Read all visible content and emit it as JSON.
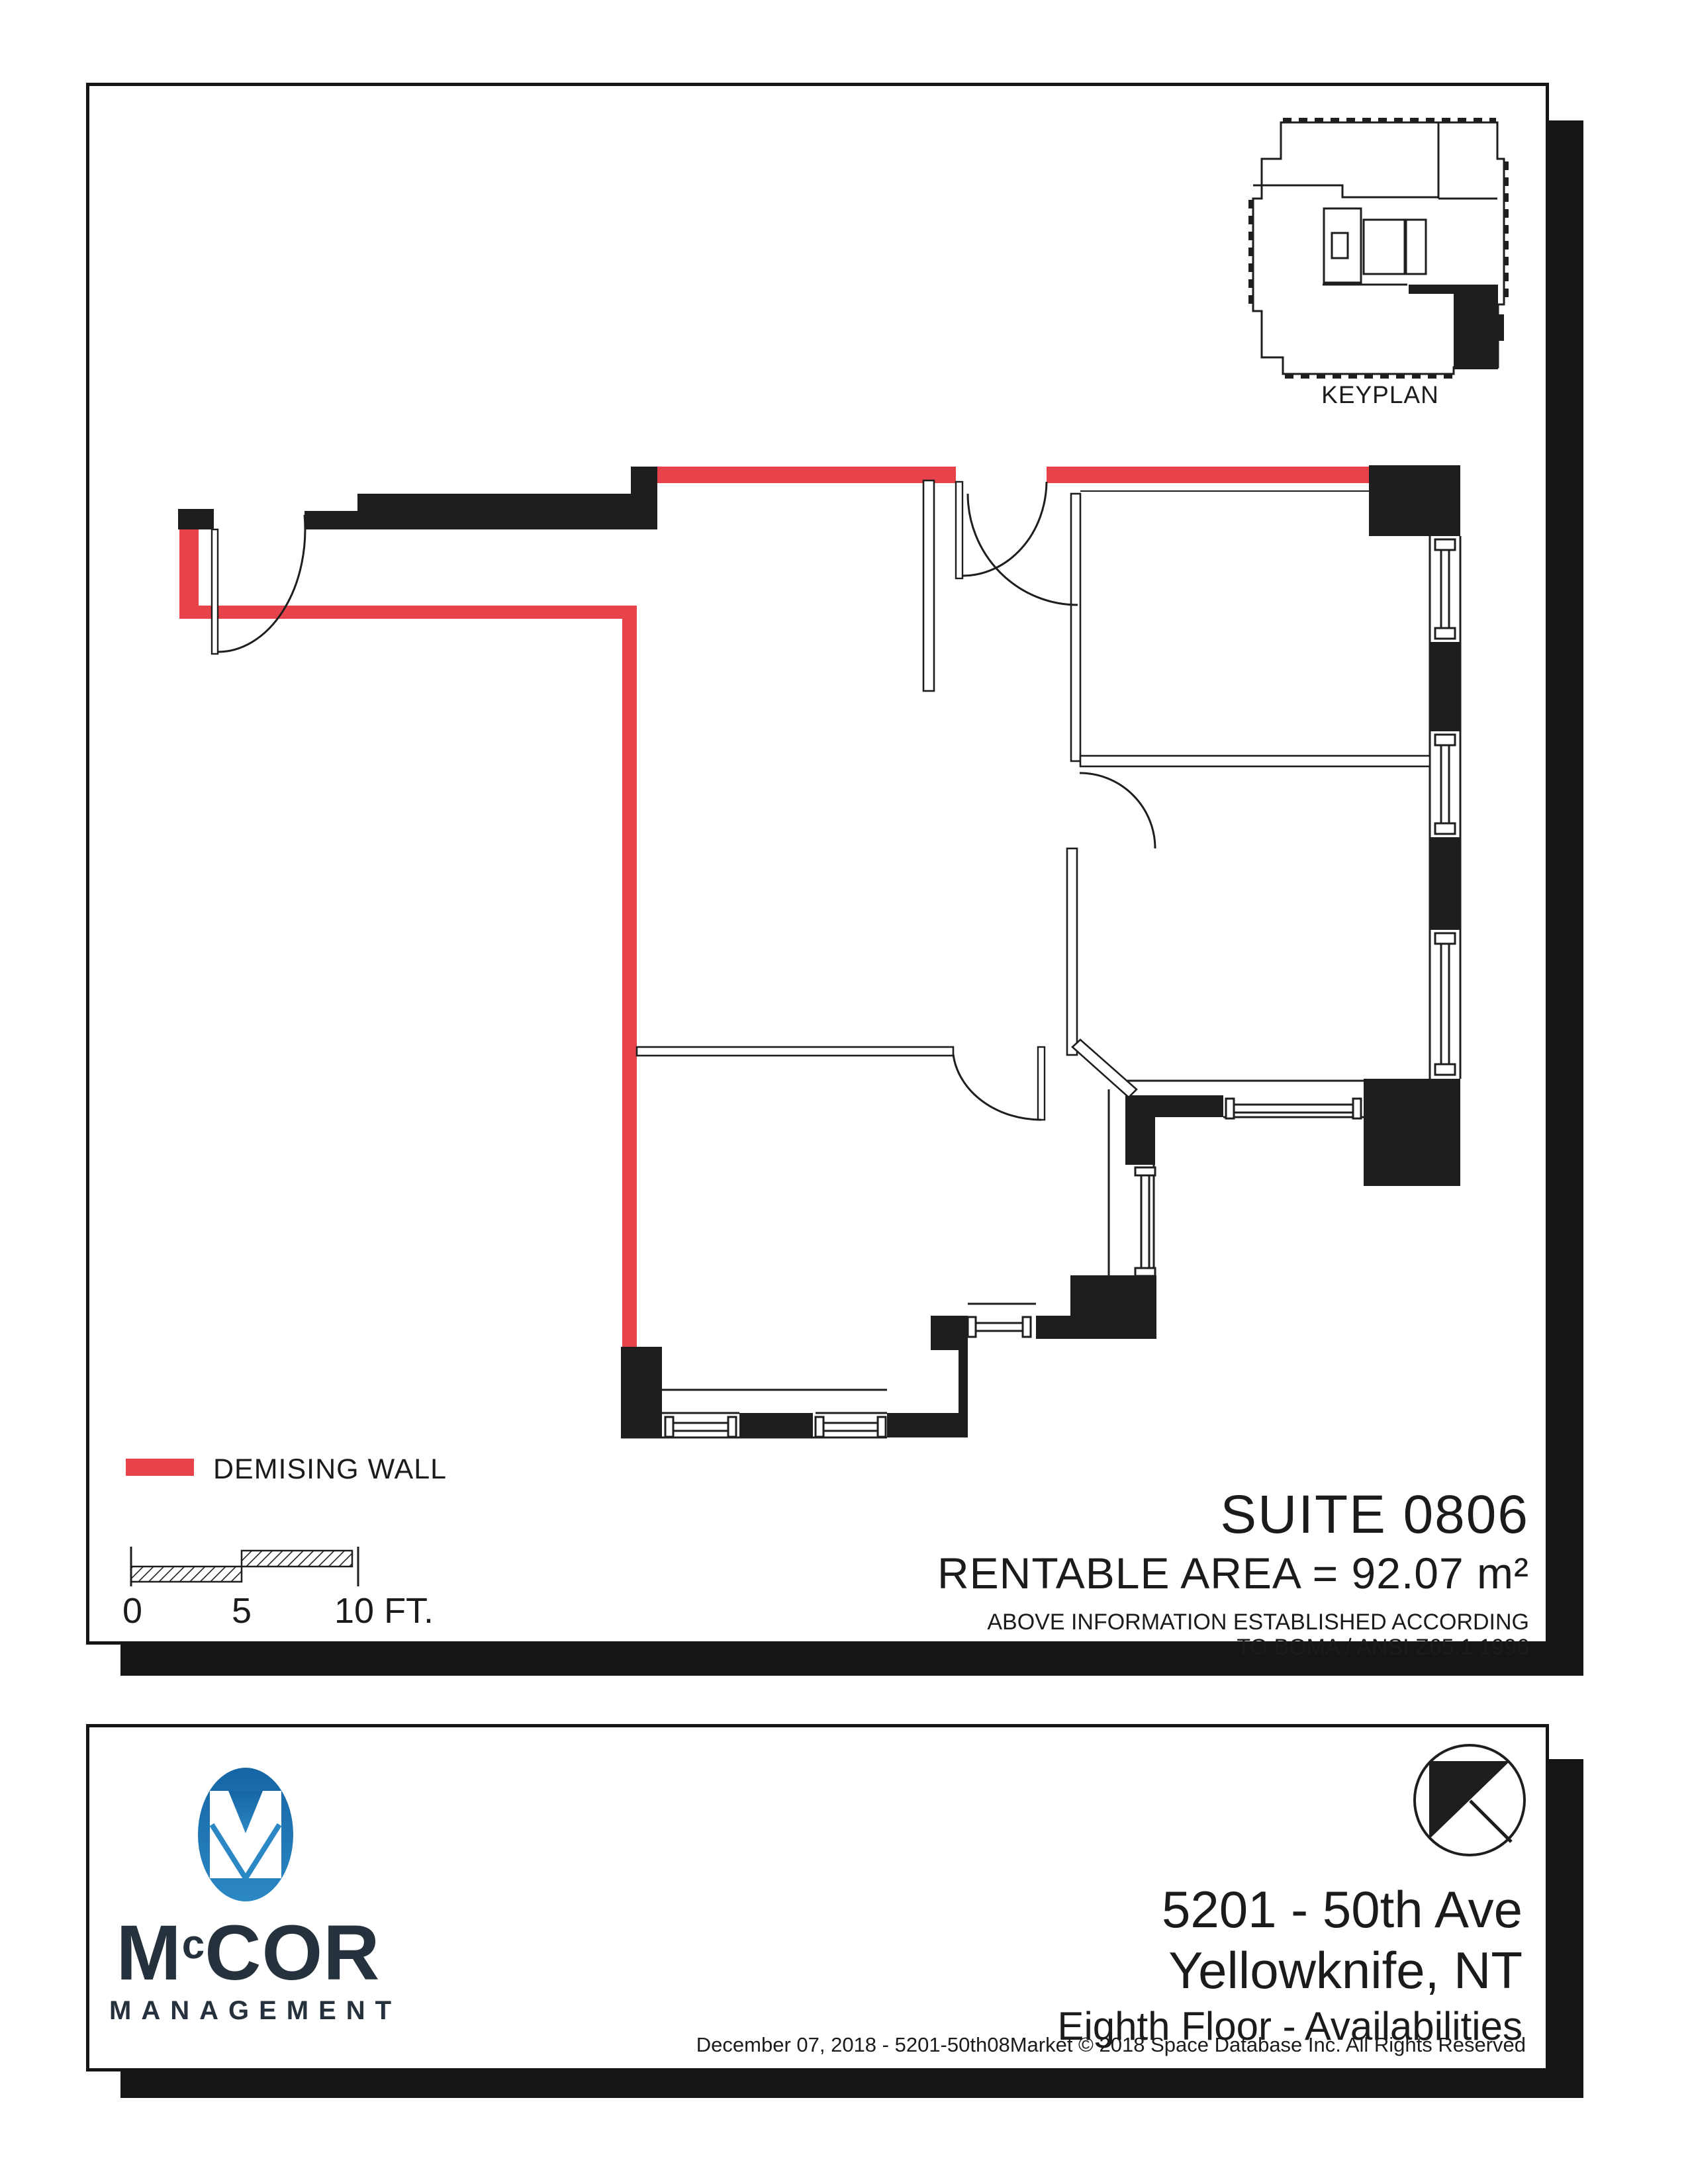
{
  "keyplan": {
    "label": "KEYPLAN"
  },
  "legend": {
    "label": "DEMISING WALL",
    "color": "#e8434a"
  },
  "scalebar": {
    "t0": "0",
    "t5": "5",
    "t10": "10 FT."
  },
  "suite": {
    "title": "SUITE 0806",
    "area": "RENTABLE AREA = 92.07 m²",
    "boma1": "ABOVE INFORMATION ESTABLISHED ACCORDING",
    "boma2": "TO BOMA / ANSI Z65.1 1996"
  },
  "footer": {
    "brand_m": "M",
    "brand_c": "c",
    "brand_rest": "COR",
    "brand_sub": "MANAGEMENT",
    "addr1": "5201 - 50th Ave",
    "addr2": "Yellowknife, NT",
    "addr3": "Eighth Floor - Availabilities",
    "copyright": "December 07, 2018  - 5201-50th08Market © 2018 Space Database Inc. All Rights Reserved"
  },
  "colors": {
    "demising_wall": "#e8434a",
    "wall_black": "#1e1e1e",
    "logo_blue_dark": "#1565a4",
    "logo_blue_light": "#2c88c4",
    "brand_navy": "#25313c"
  }
}
